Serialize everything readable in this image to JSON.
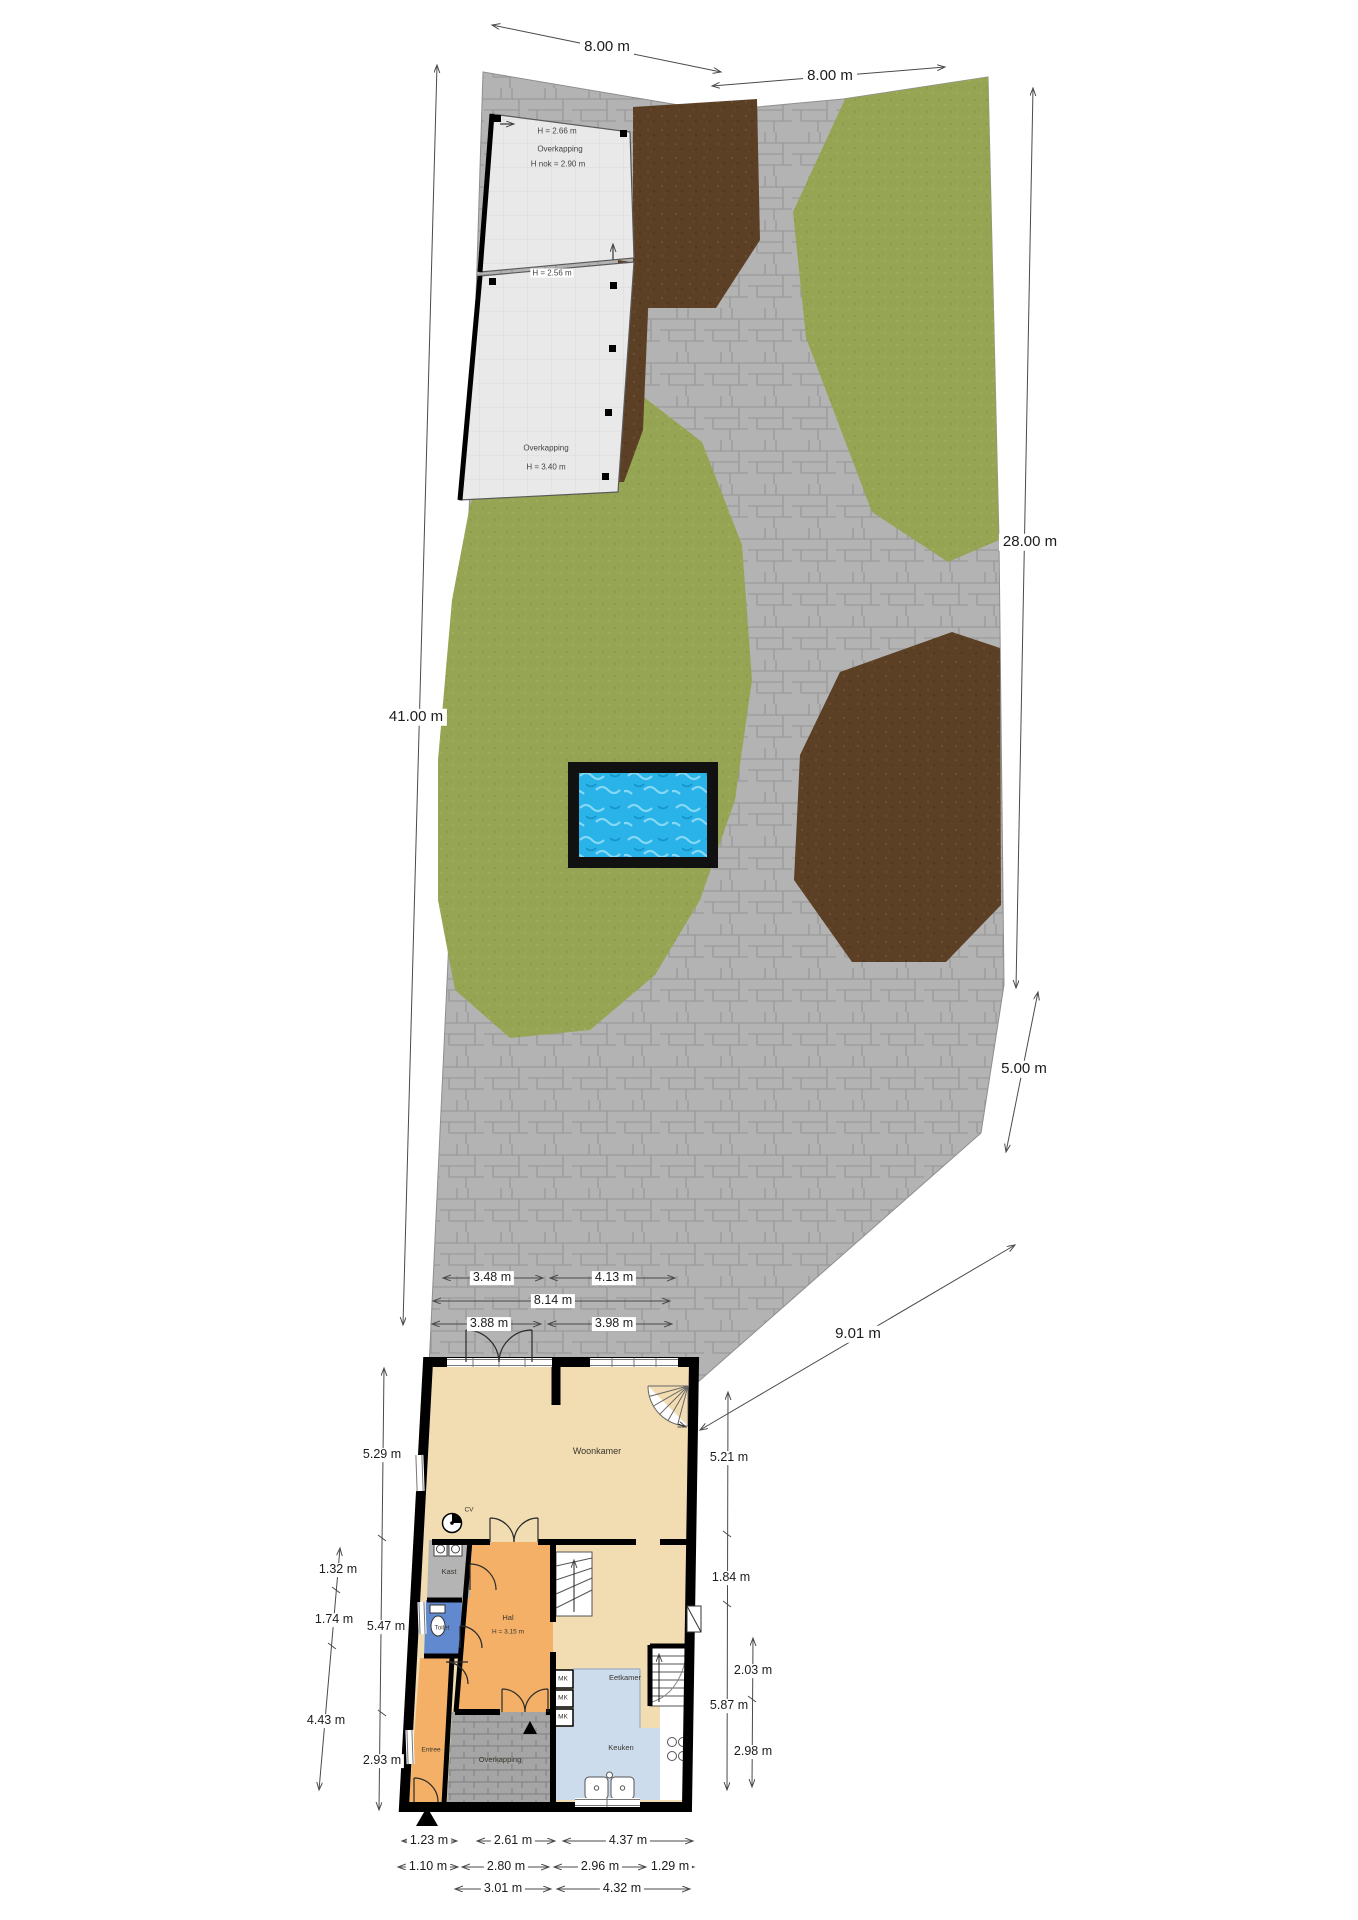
{
  "plan": {
    "site_dims": {
      "top_left": "8.00 m",
      "top_right": "8.00 m",
      "left": "41.00 m",
      "right_upper": "28.00 m",
      "right_lower": "5.00 m",
      "rear_diagonal": "9.01 m"
    },
    "terrace_dims": {
      "row1_left": "3.48 m",
      "row1_right": "4.13 m",
      "row2": "8.14 m",
      "row3_left": "3.88 m",
      "row3_right": "3.98 m"
    },
    "house_dims": {
      "left_outer_top": "5.29 m",
      "left_inner_1": "1.32 m",
      "left_inner_2": "1.74 m",
      "left_outer_mid": "5.47 m",
      "left_inner_3": "4.43 m",
      "left_outer_bottom": "2.93 m",
      "right_outer_top": "5.21 m",
      "right_outer_mid": "1.84 m",
      "right_inner_top": "2.03 m",
      "right_outer_bottom": "5.87 m",
      "right_inner_bottom": "2.98 m",
      "bottom_row1": [
        "1.23 m",
        "2.61 m",
        "4.37 m"
      ],
      "bottom_row2": [
        "1.10 m",
        "2.80 m",
        "2.96 m",
        "1.29 m"
      ],
      "bottom_row3": [
        "3.01 m",
        "4.32 m"
      ]
    },
    "garden_structures": {
      "carport_top": {
        "name": "Overkapping",
        "height_front": "H = 2.66 m",
        "height_ridge": "H nok = 2.90 m",
        "height_edge": "H = 2.56 m"
      },
      "carport_main": {
        "name": "Overkapping",
        "height": "H = 3.40 m"
      }
    },
    "rooms": {
      "woonkamer": "Woonkamer",
      "kast": "Kast",
      "toilet": "Toilet",
      "hal": "Hal",
      "hal_height": "H = 3.15 m",
      "eetkamer": "Eetkamer",
      "keuken": "Keuken",
      "entree": "Entree",
      "overkapping": "Overkapping",
      "meter_cabinet": "MK",
      "boiler": "CV"
    },
    "colors": {
      "paving": "#b3b3b3",
      "grass": "#96a553",
      "soil": "#5c4026",
      "water": "#29b3e8",
      "living": "#f2dcb2",
      "hall": "#f3b066",
      "kitchen": "#ccdcec",
      "toilet": "#6089cf",
      "closet": "#b4b4b4",
      "carport": "#e9e9e9"
    }
  }
}
